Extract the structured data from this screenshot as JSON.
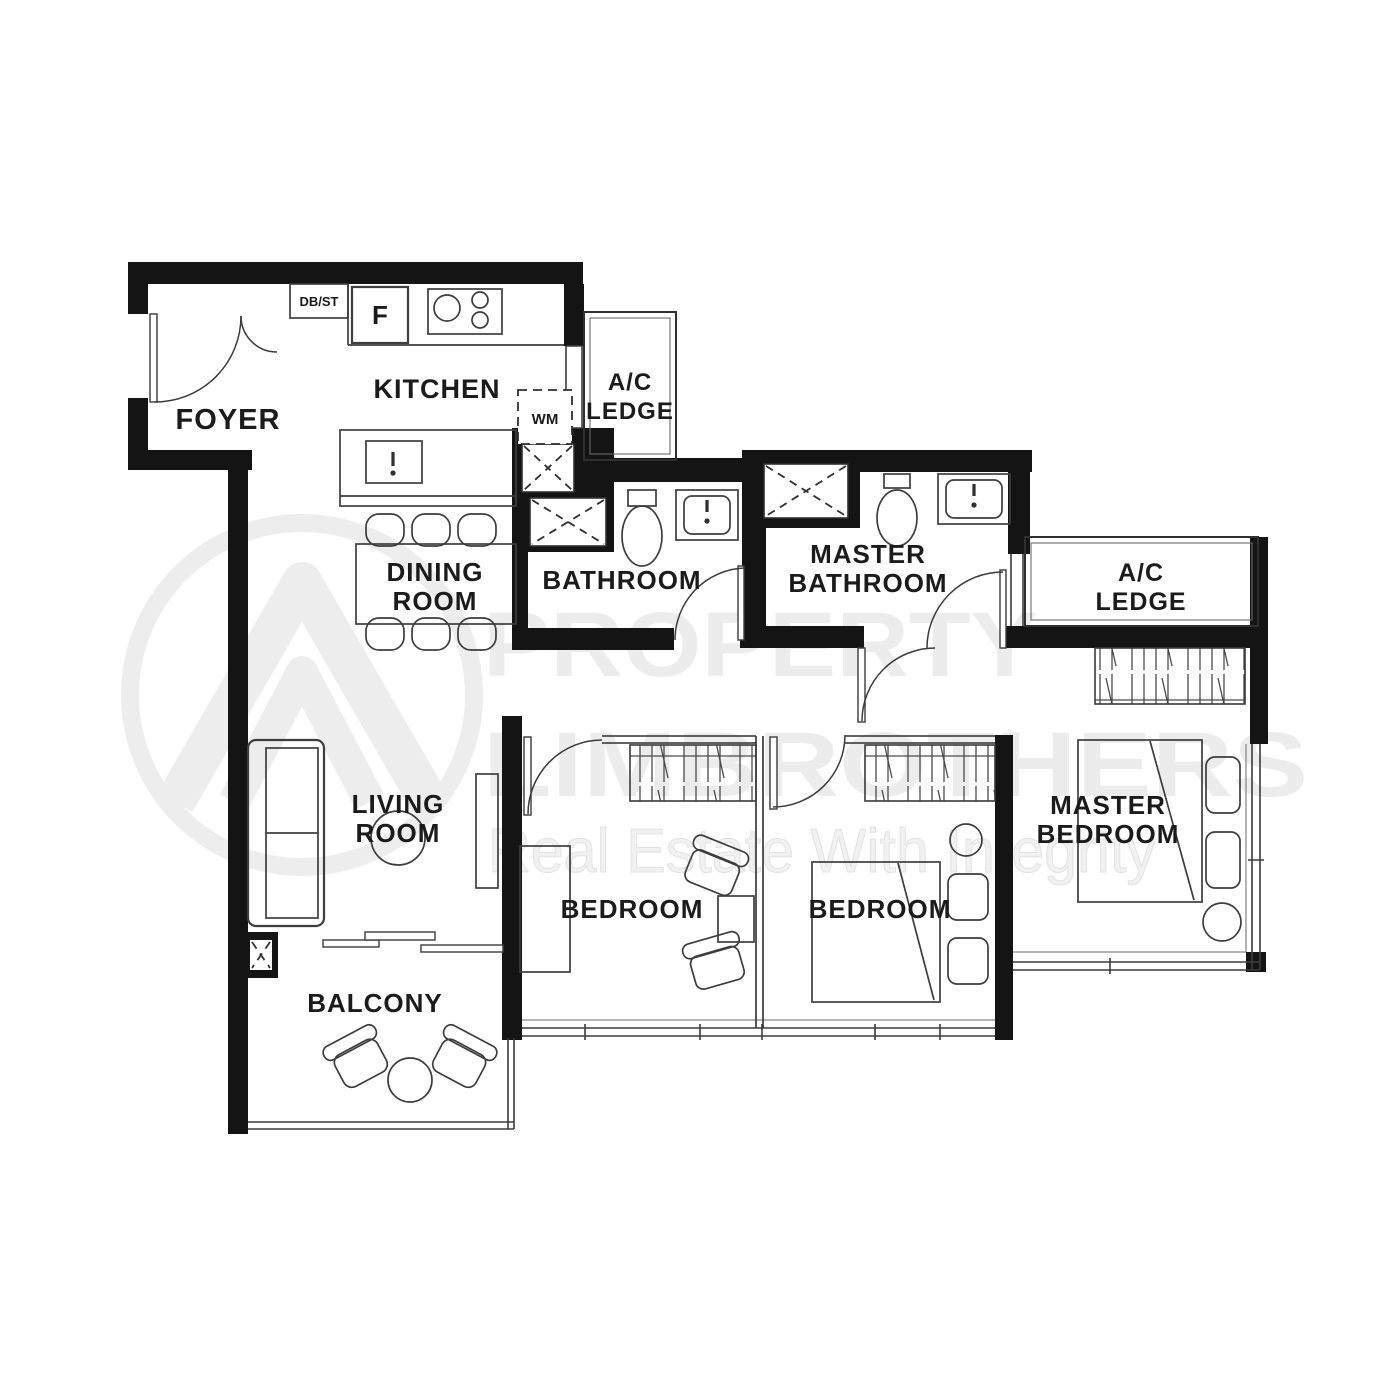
{
  "labels": {
    "foyer": "FOYER",
    "kitchen": "KITCHEN",
    "ac_ledge_1a": "A/C",
    "ac_ledge_1b": "LEDGE",
    "dining_a": "DINING",
    "dining_b": "ROOM",
    "bathroom": "BATHROOM",
    "master_bath_a": "MASTER",
    "master_bath_b": "BATHROOM",
    "ac_ledge_2a": "A/C",
    "ac_ledge_2b": "LEDGE",
    "living_a": "LIVING",
    "living_b": "ROOM",
    "bedroom1": "BEDROOM",
    "bedroom2": "BEDROOM",
    "master_bed_a": "MASTER",
    "master_bed_b": "BEDROOM",
    "balcony": "BALCONY"
  },
  "fixtures": {
    "db_st": "DB/ST",
    "fridge": "F",
    "washing_machine": "WM"
  },
  "watermark": {
    "line1": "PROPERTY",
    "line2": "LIMBROTHERS",
    "tagline": "Real Estate With Integrity"
  },
  "colors": {
    "wall": "#141414",
    "label": "#1b1b1b",
    "furniture": "#3d3d3d",
    "watermark": "#ececec"
  }
}
